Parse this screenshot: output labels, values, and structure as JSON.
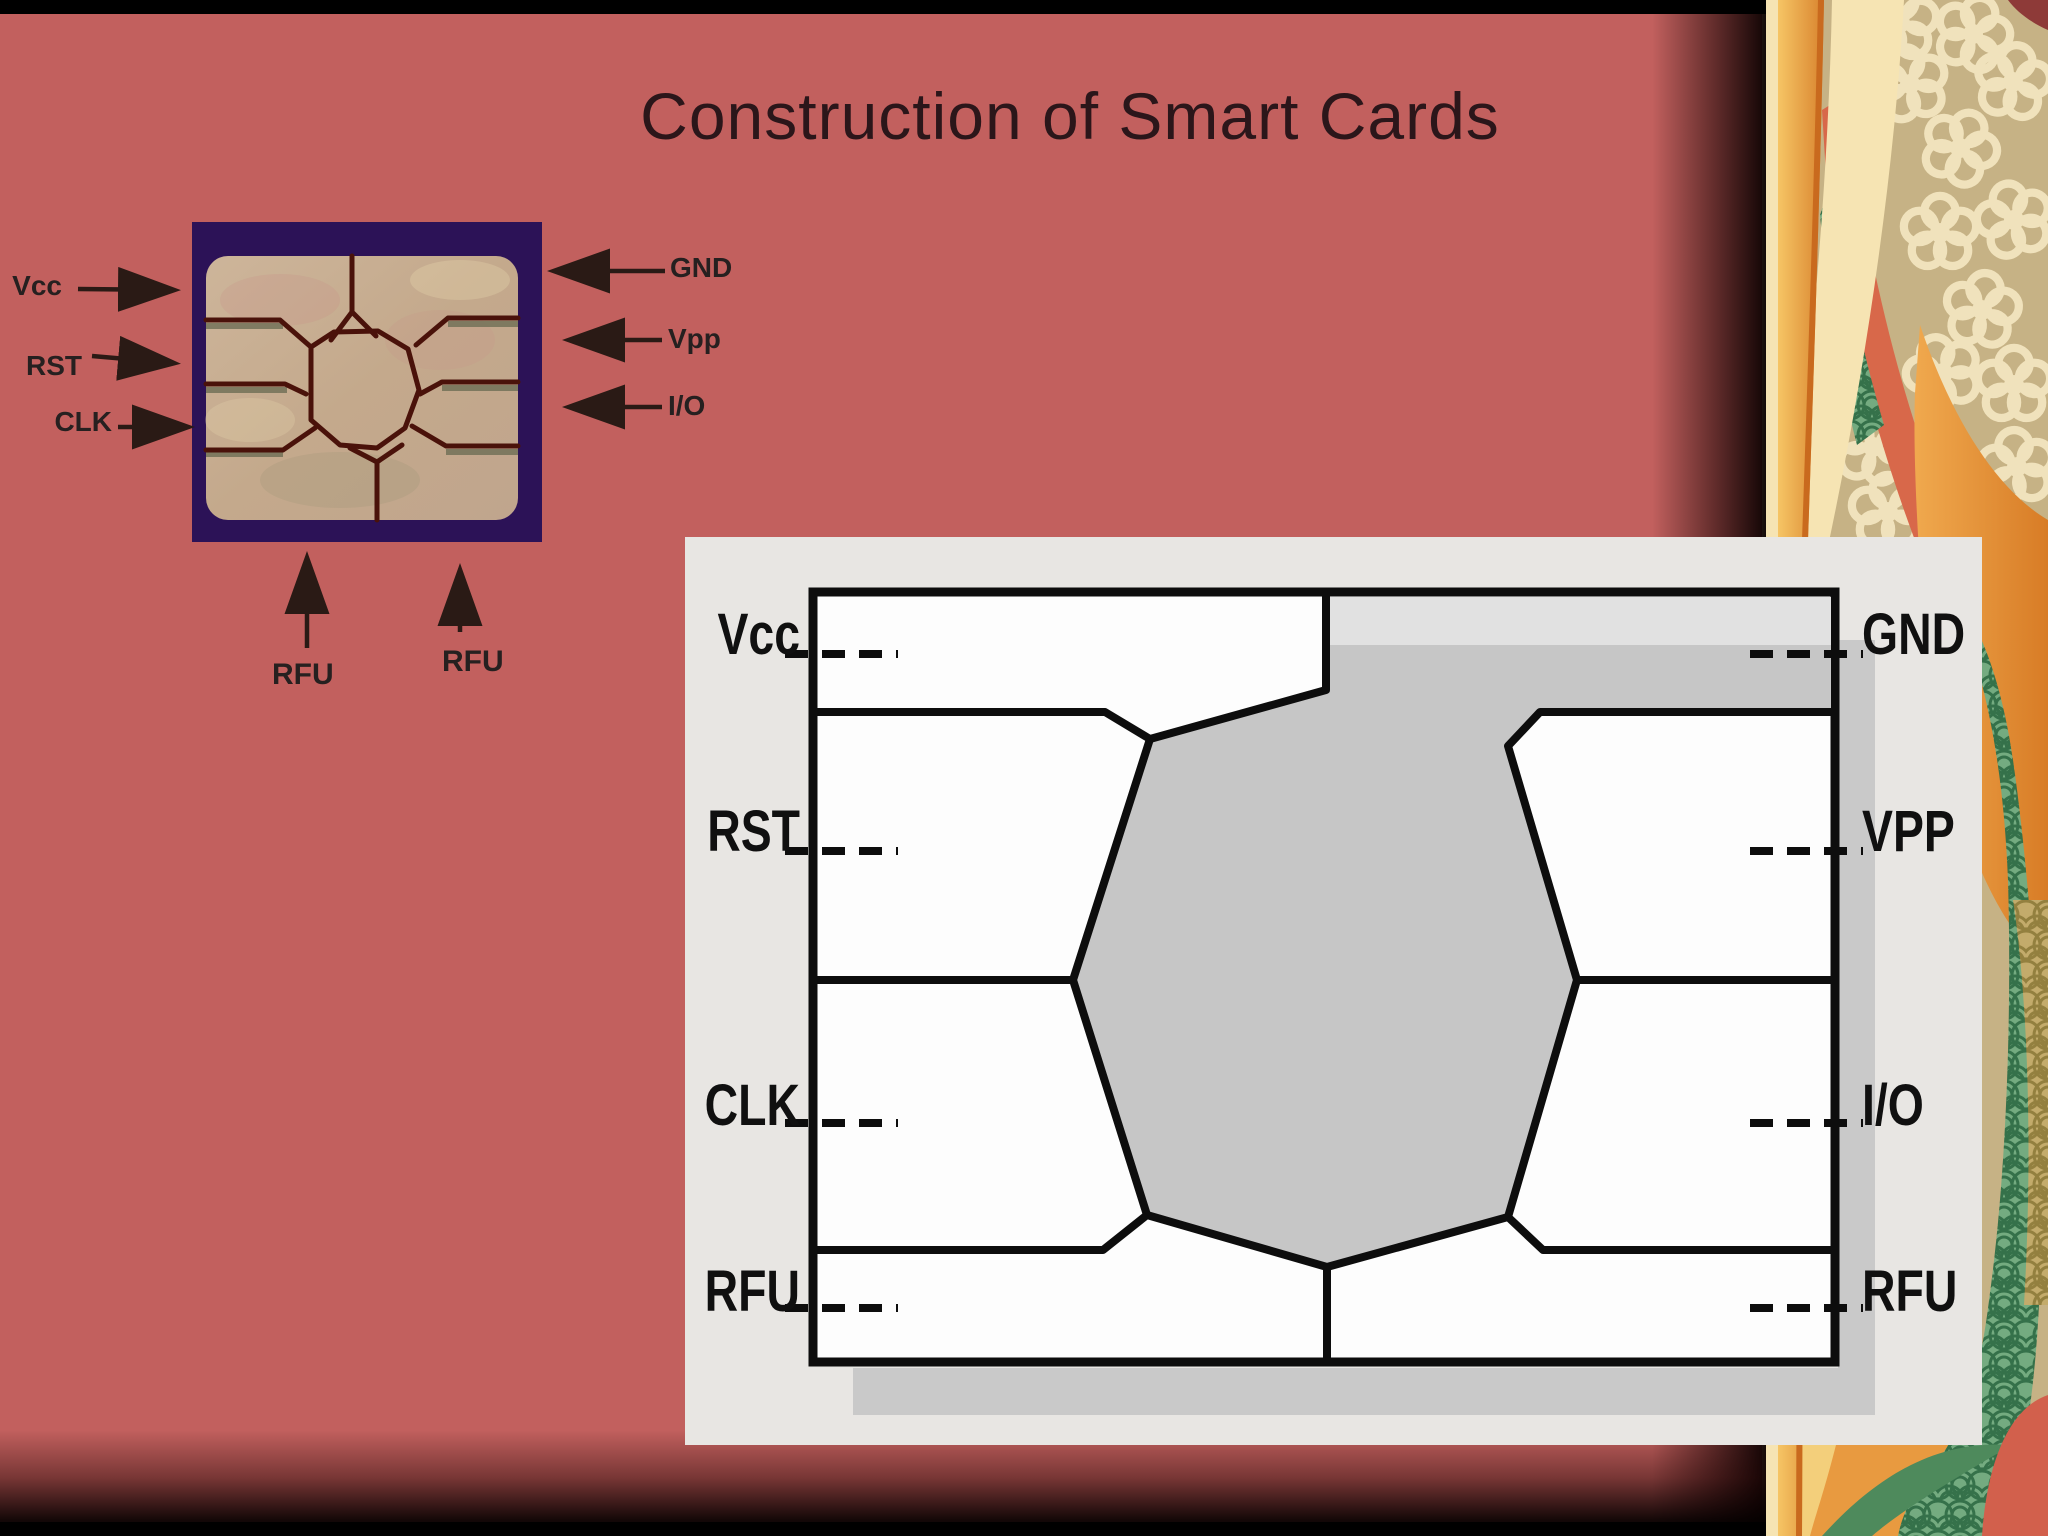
{
  "slide": {
    "title": "Construction of Smart Cards",
    "background_color": "#c2605e",
    "frame_bar_color": "#000000"
  },
  "chip_photo": {
    "left_labels": [
      "Vcc",
      "RST",
      "CLK"
    ],
    "right_labels": [
      "GND",
      "Vpp",
      "I/O"
    ],
    "bottom_labels": [
      "RFU",
      "RFU"
    ],
    "colors": {
      "module_background": "#2c1257",
      "contact_gold": "#c8ae90",
      "separation_lines": "#4a120a",
      "label_text": "#262020"
    }
  },
  "contact_diagram": {
    "left_labels": [
      "Vcc",
      "RST",
      "CLK",
      "RFU"
    ],
    "right_labels": [
      "GND",
      "VPP",
      "I/O",
      "RFU"
    ],
    "colors": {
      "panel": "#e8e6e3",
      "drop_shadow": "#c9c9c9",
      "pad_white": "#fdfdfd",
      "center_gray": "#c6c6c6",
      "gnd_band": "#e1e1e1",
      "outline": "#0d0d0d",
      "label_text": "#101010"
    }
  },
  "decorative_border": {
    "colors": {
      "khaki": "#c6b285",
      "cream": "#f6e4b3",
      "orange": "#e0893a",
      "salmon": "#d8684a",
      "green": "#74ab80",
      "gold": "#c3ab6b",
      "red_accent": "#d2604c"
    }
  }
}
